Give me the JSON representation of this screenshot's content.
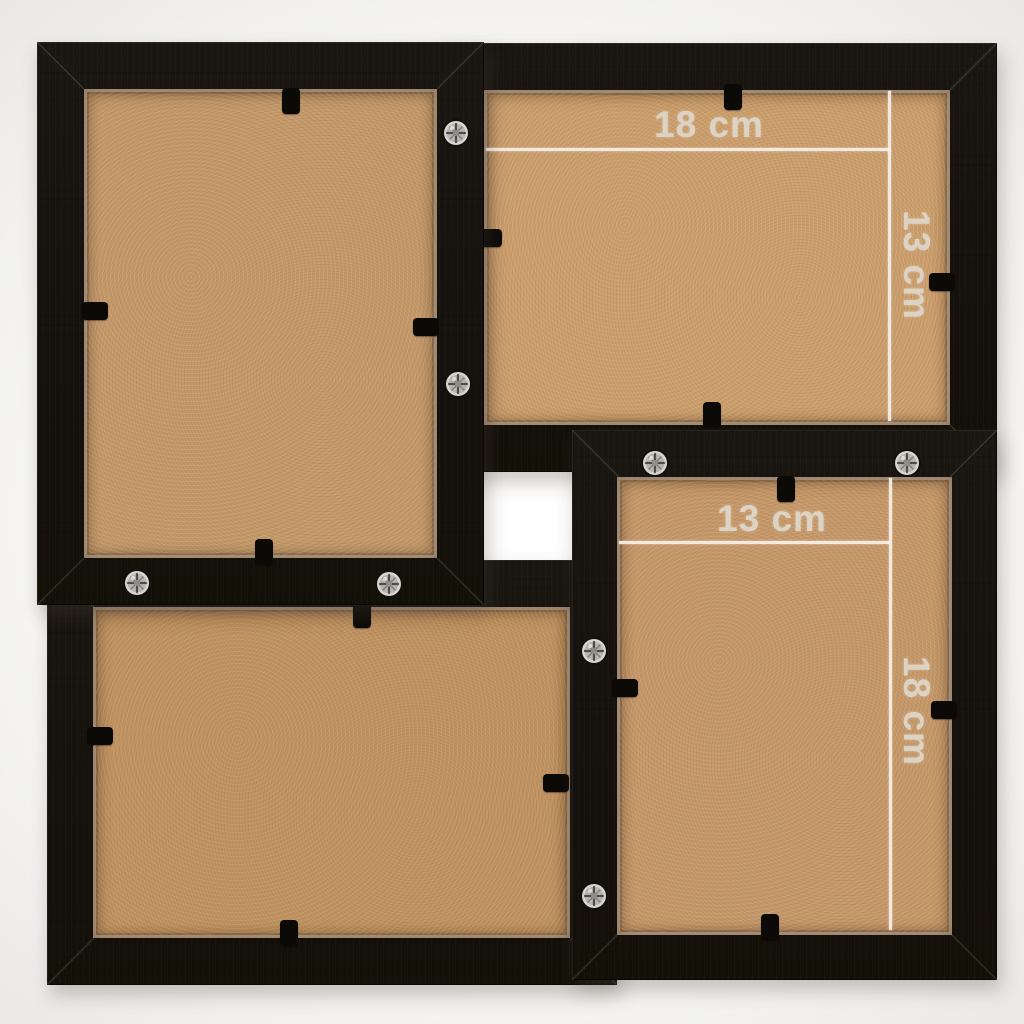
{
  "product_photo": {
    "subject": "four-photo collage frame, rear view with backing boards",
    "frames": {
      "top_right": {
        "width_label": "18 cm",
        "height_label": "13 cm"
      },
      "bottom_right": {
        "width_label": "13 cm",
        "height_label": "18 cm"
      }
    }
  },
  "colors": {
    "frame_black": "#17130f",
    "board_tan": "#c79a68",
    "measure_line": "#f2eee6",
    "measure_text": "#dcd3c5",
    "background_center": "#ffffff",
    "background_edge": "#e8e7e5"
  }
}
